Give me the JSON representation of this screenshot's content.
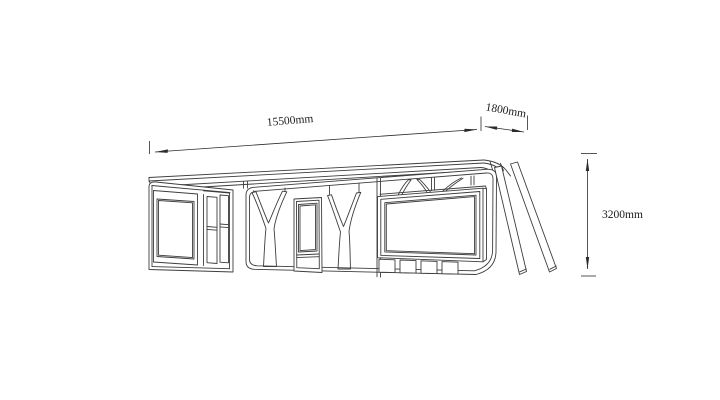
{
  "page": {
    "background_color": "#ffffff"
  },
  "drawing": {
    "stroke_color": "#3d3d3d",
    "dimension_labels": {
      "length": "15500mm",
      "depth": "1800mm",
      "height": "3200mm"
    }
  }
}
